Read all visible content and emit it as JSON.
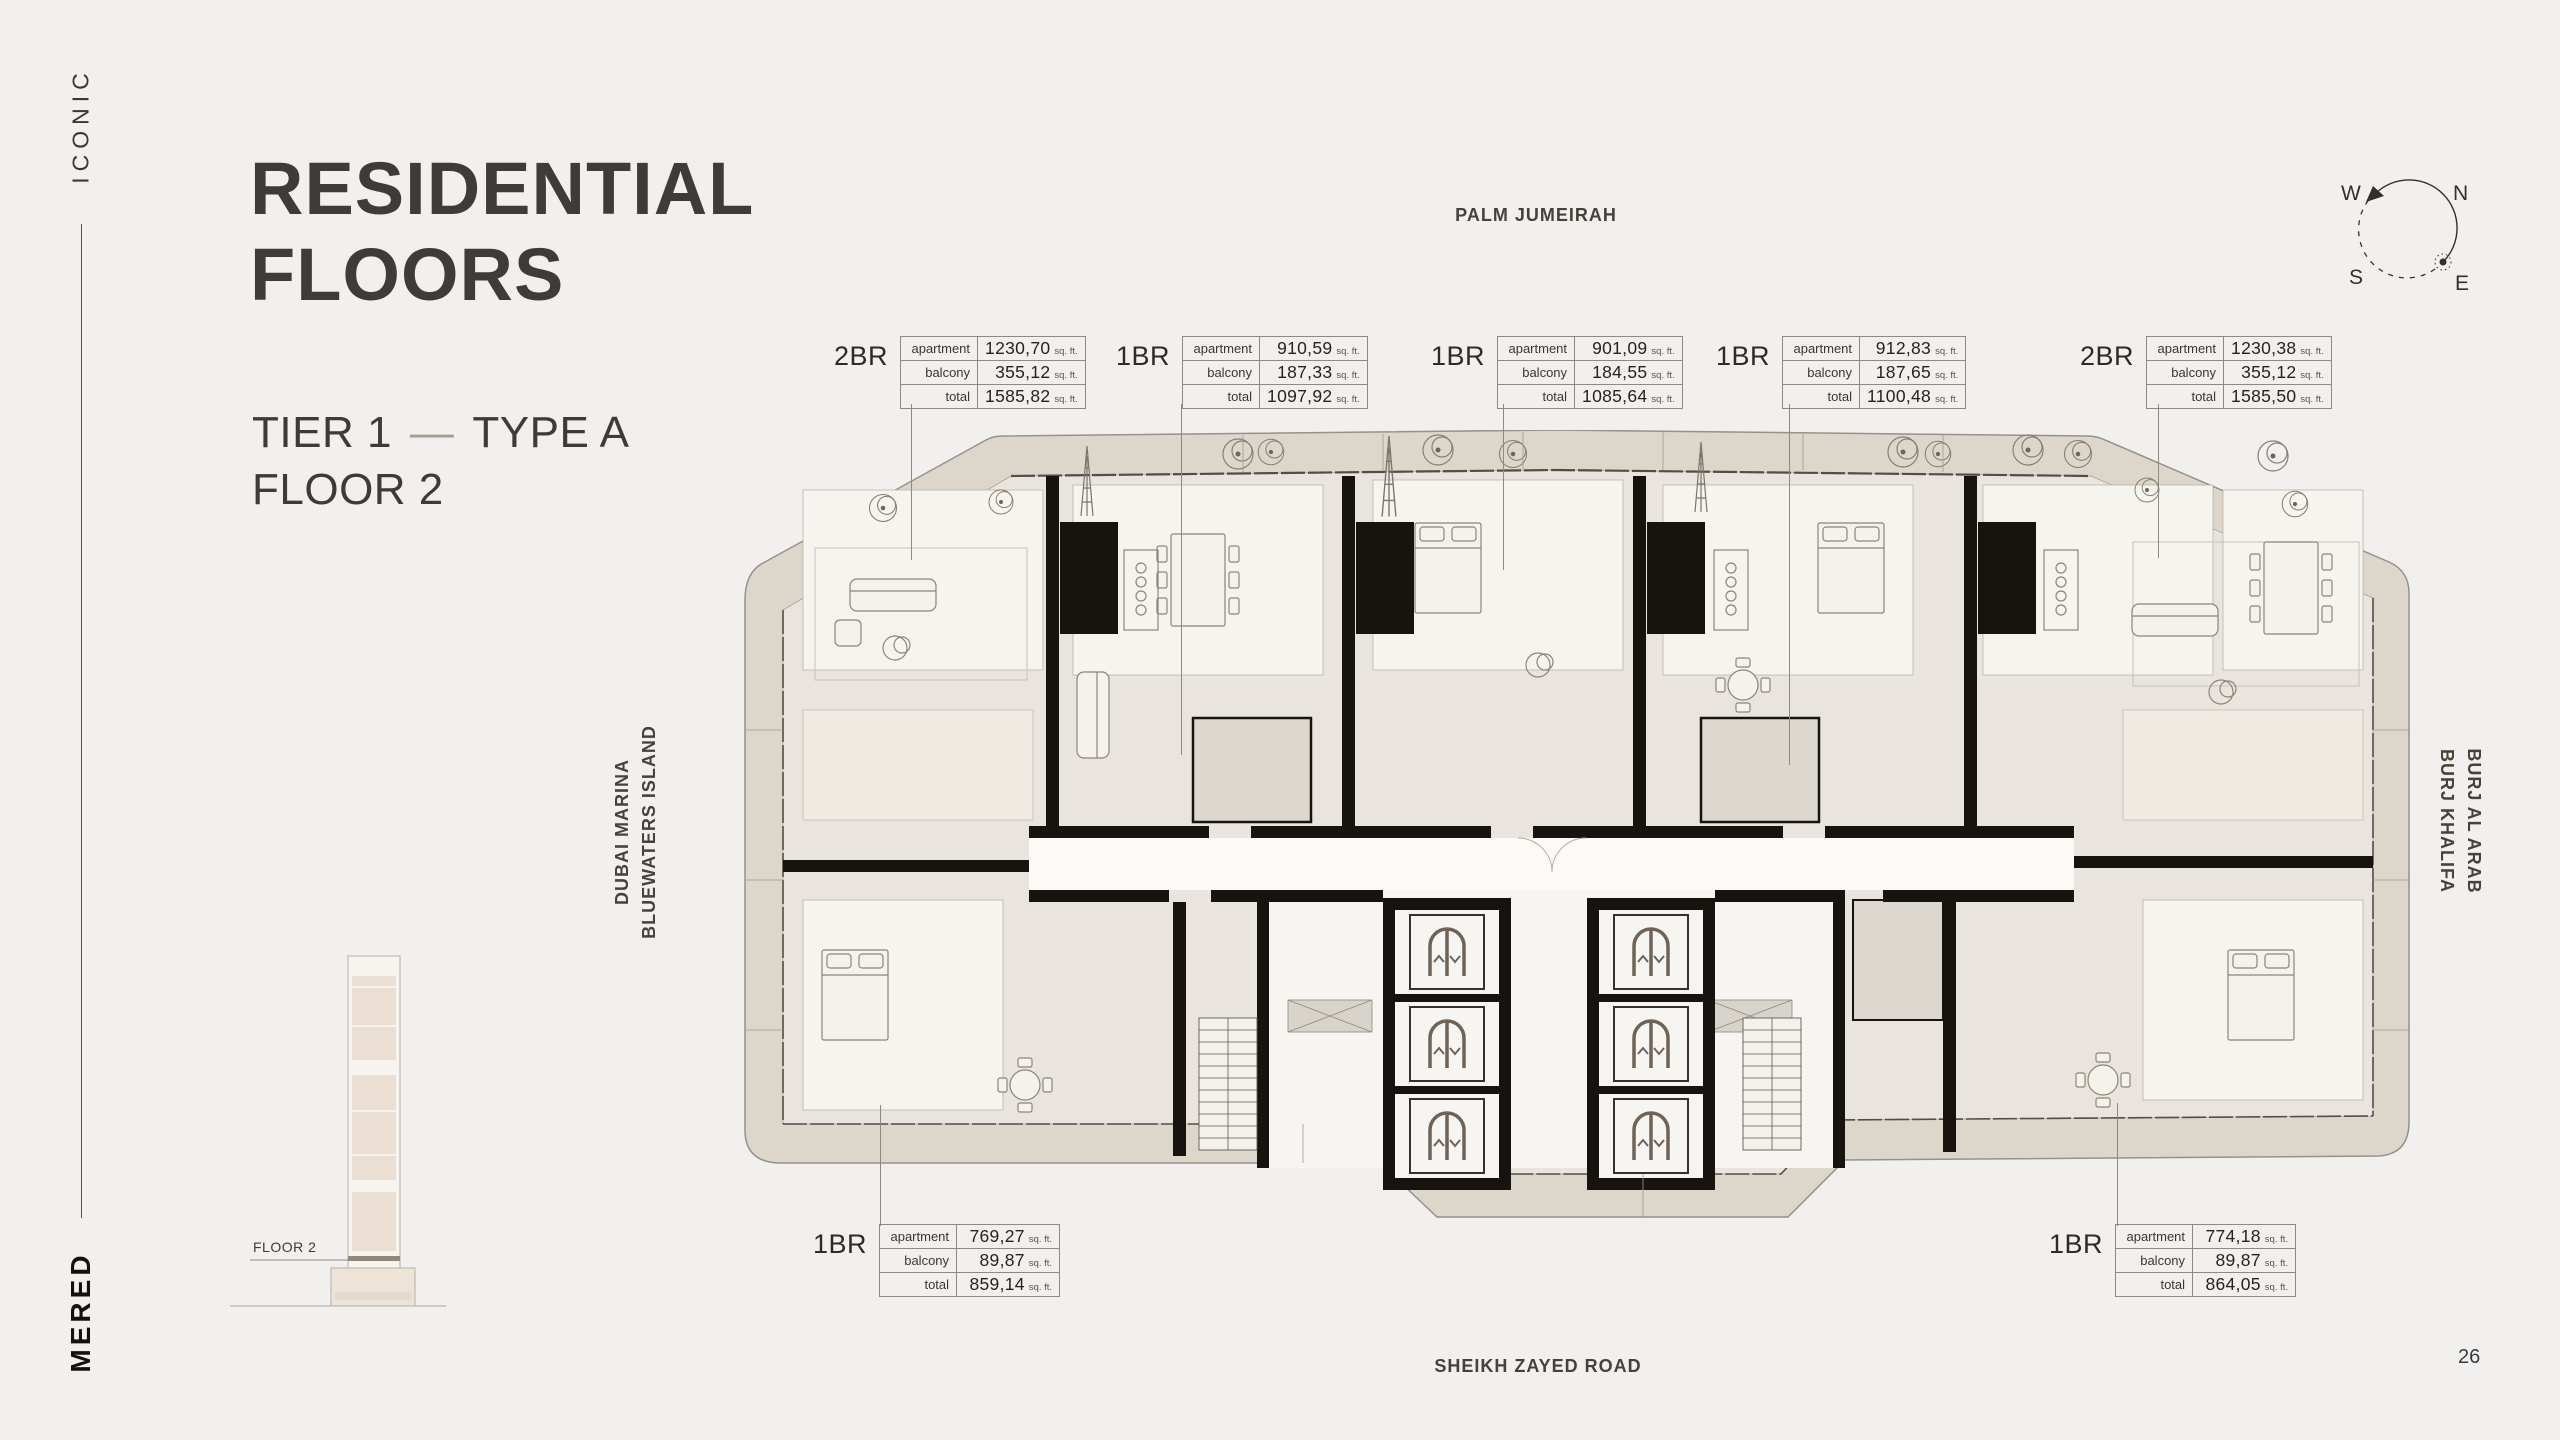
{
  "brand": {
    "top": "ICONIC",
    "bottom": "MERED"
  },
  "header": {
    "title_line1": "RESIDENTIAL",
    "title_line2": "FLOORS",
    "tier": "TIER 1",
    "dash": "—",
    "type": "TYPE A",
    "floor": "FLOOR 2"
  },
  "building_diagram": {
    "floor_label": "FLOOR 2"
  },
  "compass": {
    "n": "N",
    "e": "E",
    "s": "S",
    "w": "W"
  },
  "surroundings": {
    "top": "PALM JUMEIRAH",
    "left_line1": "DUBAI MARINA",
    "left_line2": "BLUEWATERS ISLAND",
    "right_line1": "BURJ AL ARAB",
    "right_line2": "BURJ KHALIFA",
    "bottom": "SHEIKH ZAYED ROAD"
  },
  "unit_tables": {
    "row_labels": [
      "apartment",
      "balcony",
      "total"
    ],
    "unit": "sq. ft.",
    "top": [
      {
        "type": "2BR",
        "apartment": "1230,70",
        "balcony": "355,12",
        "total": "1585,82"
      },
      {
        "type": "1BR",
        "apartment": "910,59",
        "balcony": "187,33",
        "total": "1097,92"
      },
      {
        "type": "1BR",
        "apartment": "901,09",
        "balcony": "184,55",
        "total": "1085,64"
      },
      {
        "type": "1BR",
        "apartment": "912,83",
        "balcony": "187,65",
        "total": "1100,48"
      },
      {
        "type": "2BR",
        "apartment": "1230,38",
        "balcony": "355,12",
        "total": "1585,50"
      }
    ],
    "bottom": [
      {
        "type": "1BR",
        "apartment": "769,27",
        "balcony": "89,87",
        "total": "859,14"
      },
      {
        "type": "1BR",
        "apartment": "774,18",
        "balcony": "89,87",
        "total": "864,05"
      }
    ]
  },
  "page": {
    "number": "26"
  }
}
